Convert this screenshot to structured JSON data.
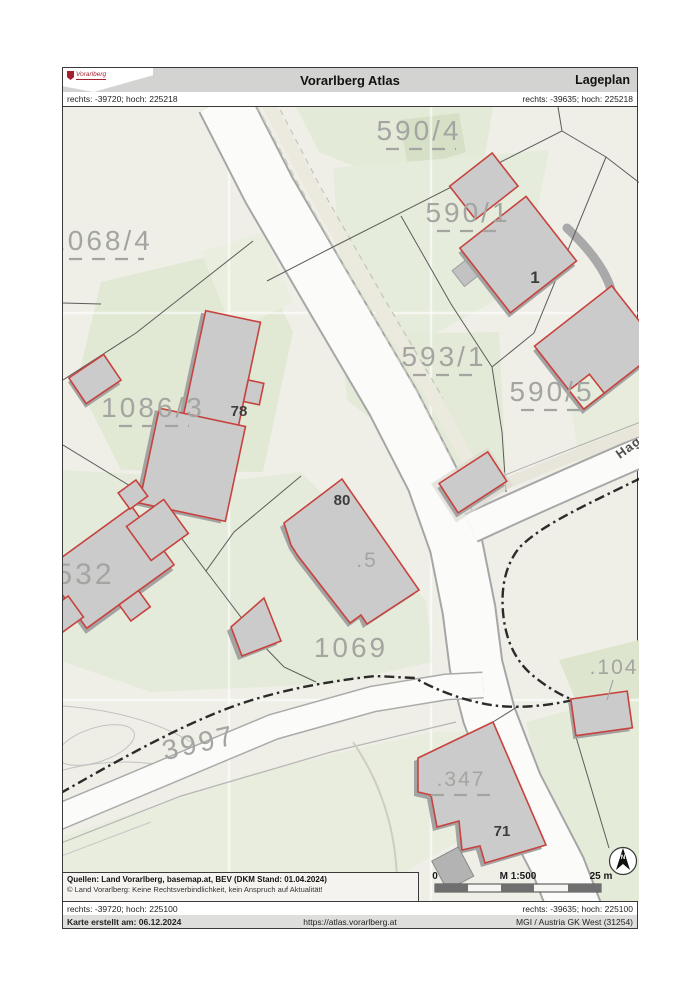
{
  "page": {
    "title": "Vorarlberg Atlas",
    "subtitle": "Lageplan",
    "logo": "Vorarlberg"
  },
  "coordinates": {
    "top_left": "rechts: -39720; hoch: 225218",
    "top_right": "rechts: -39635; hoch: 225218",
    "bottom_left": "rechts: -39720; hoch: 225100",
    "bottom_right": "rechts: -39635; hoch: 225100"
  },
  "map": {
    "parcels": [
      {
        "text": "590/4"
      },
      {
        "text": "1068/4"
      },
      {
        "text": "590/1"
      },
      {
        "text": "593/1"
      },
      {
        "text": "1086/3"
      },
      {
        "text": "590/5"
      },
      {
        "text": "1069"
      },
      {
        "text": "3997"
      },
      {
        "text": ".347"
      },
      {
        "text": ".104"
      },
      {
        "text": ".5"
      },
      {
        "text": "532"
      }
    ],
    "street": "Hag",
    "buildings": [
      {
        "text": "1"
      },
      {
        "text": "78"
      },
      {
        "text": "80"
      },
      {
        "text": "71"
      }
    ],
    "north_label": "N",
    "colors": {
      "building_outline": "#c7433e",
      "building_fill": "#cbcbcb",
      "vegetation": "#e4ead8",
      "boundary_line": "#151515"
    }
  },
  "scalebar": {
    "zero": "0",
    "ratio": "M 1:500",
    "distance": "25 m"
  },
  "legend": {
    "sources": "Quellen: Land Vorarlberg, basemap.at, BEV (DKM Stand: 01.04.2024)",
    "copyright": "© Land Vorarlberg: Keine Rechtsverbindlichkeit, kein Anspruch auf Aktualität!"
  },
  "footer": {
    "created": "Karte erstellt am: 06.12.2024",
    "url": "https://atlas.vorarlberg.at",
    "crs": "MGI / Austria GK West (31254)"
  }
}
